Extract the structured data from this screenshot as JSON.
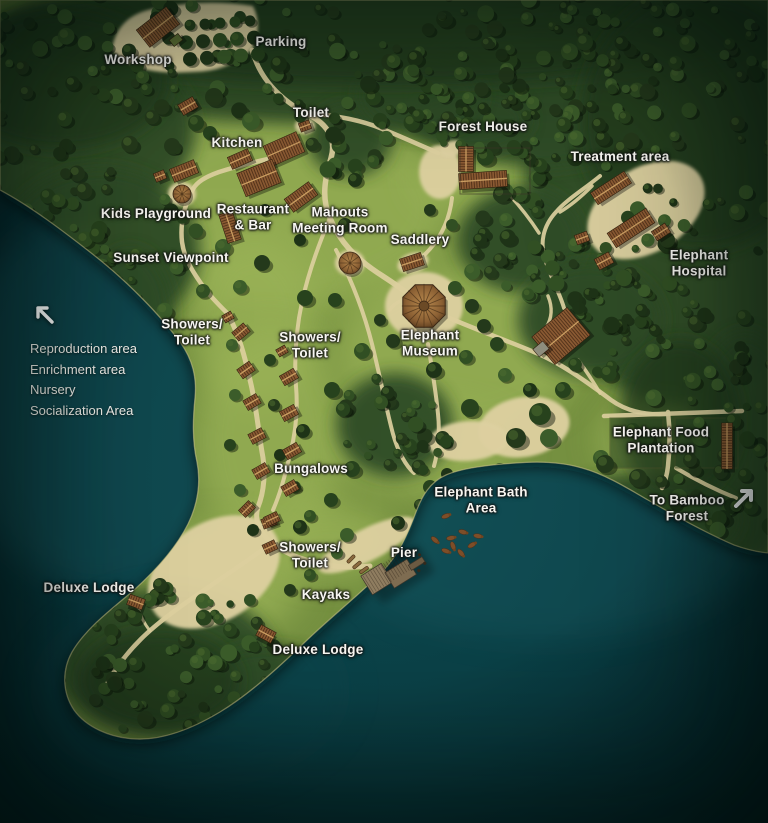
{
  "map": {
    "width": 768,
    "height": 823,
    "labels": [
      {
        "id": "workshop",
        "text": "Workshop",
        "x": 138,
        "y": 60
      },
      {
        "id": "parking",
        "text": "Parking",
        "x": 281,
        "y": 42
      },
      {
        "id": "toilet",
        "text": "Toilet",
        "x": 311,
        "y": 113
      },
      {
        "id": "kitchen",
        "text": "Kitchen",
        "x": 237,
        "y": 143
      },
      {
        "id": "forest-house",
        "text": "Forest House",
        "x": 483,
        "y": 127
      },
      {
        "id": "treatment-area",
        "text": "Treatment area",
        "x": 620,
        "y": 157
      },
      {
        "id": "kids-playground",
        "text": "Kids Playground",
        "x": 156,
        "y": 214
      },
      {
        "id": "restaurant-bar",
        "text": "Restaurant\n& Bar",
        "x": 253,
        "y": 217
      },
      {
        "id": "mahouts-meeting-room",
        "text": "Mahouts\nMeeting Room",
        "x": 340,
        "y": 220
      },
      {
        "id": "saddlery",
        "text": "Saddlery",
        "x": 420,
        "y": 240
      },
      {
        "id": "sunset-viewpoint",
        "text": "Sunset Viewpoint",
        "x": 171,
        "y": 258
      },
      {
        "id": "elephant-hospital",
        "text": "Elephant Hospital",
        "x": 699,
        "y": 263
      },
      {
        "id": "showers-toilet-north",
        "text": "Showers/\nToilet",
        "x": 192,
        "y": 332
      },
      {
        "id": "showers-toilet-mid",
        "text": "Showers/\nToilet",
        "x": 310,
        "y": 345
      },
      {
        "id": "elephant-museum",
        "text": "Elephant\nMuseum",
        "x": 430,
        "y": 343
      },
      {
        "id": "elephant-food-plantation",
        "text": "Elephant Food\nPlantation",
        "x": 661,
        "y": 440
      },
      {
        "id": "bungalows",
        "text": "Bungalows",
        "x": 311,
        "y": 469
      },
      {
        "id": "elephant-bath-area",
        "text": "Elephant Bath\nArea",
        "x": 481,
        "y": 500
      },
      {
        "id": "to-bamboo-forest",
        "text": "To Bamboo\nForest",
        "x": 687,
        "y": 508
      },
      {
        "id": "showers-toilet-south",
        "text": "Showers/\nToilet",
        "x": 310,
        "y": 555
      },
      {
        "id": "pier",
        "text": "Pier",
        "x": 404,
        "y": 553
      },
      {
        "id": "kayaks",
        "text": "Kayaks",
        "x": 326,
        "y": 595
      },
      {
        "id": "deluxe-lodge-west",
        "text": "Deluxe Lodge",
        "x": 89,
        "y": 588
      },
      {
        "id": "deluxe-lodge-south",
        "text": "Deluxe Lodge",
        "x": 318,
        "y": 650
      }
    ],
    "legend": {
      "x": 30,
      "y": 300,
      "arrow_direction": "northwest",
      "items": [
        "Reproduction area",
        "Enrichment area",
        "Nursery",
        "Socialization Area"
      ]
    },
    "direction_arrow": {
      "id": "northeast-arrow",
      "direction": "northeast",
      "x": 732,
      "y": 484
    },
    "colors": {
      "water_deep": "#021318",
      "water_dark": "#05262c",
      "water_mid": "#0a3d43",
      "water_light": "#0e4a50",
      "water_shallow": "#1a6168",
      "land_grass": "#75903f",
      "grass_light": "#9ab257",
      "forest": "#2e4b25",
      "forest_dark": "#223a1a",
      "sand": "#ddd0a0",
      "path": "#dccf9e",
      "roof": "#8a5a33",
      "roof_stripe": "#52321a",
      "roof_ridge": "#c99d61",
      "field": "#2c4824",
      "label_text": "#f7f6f1"
    }
  }
}
